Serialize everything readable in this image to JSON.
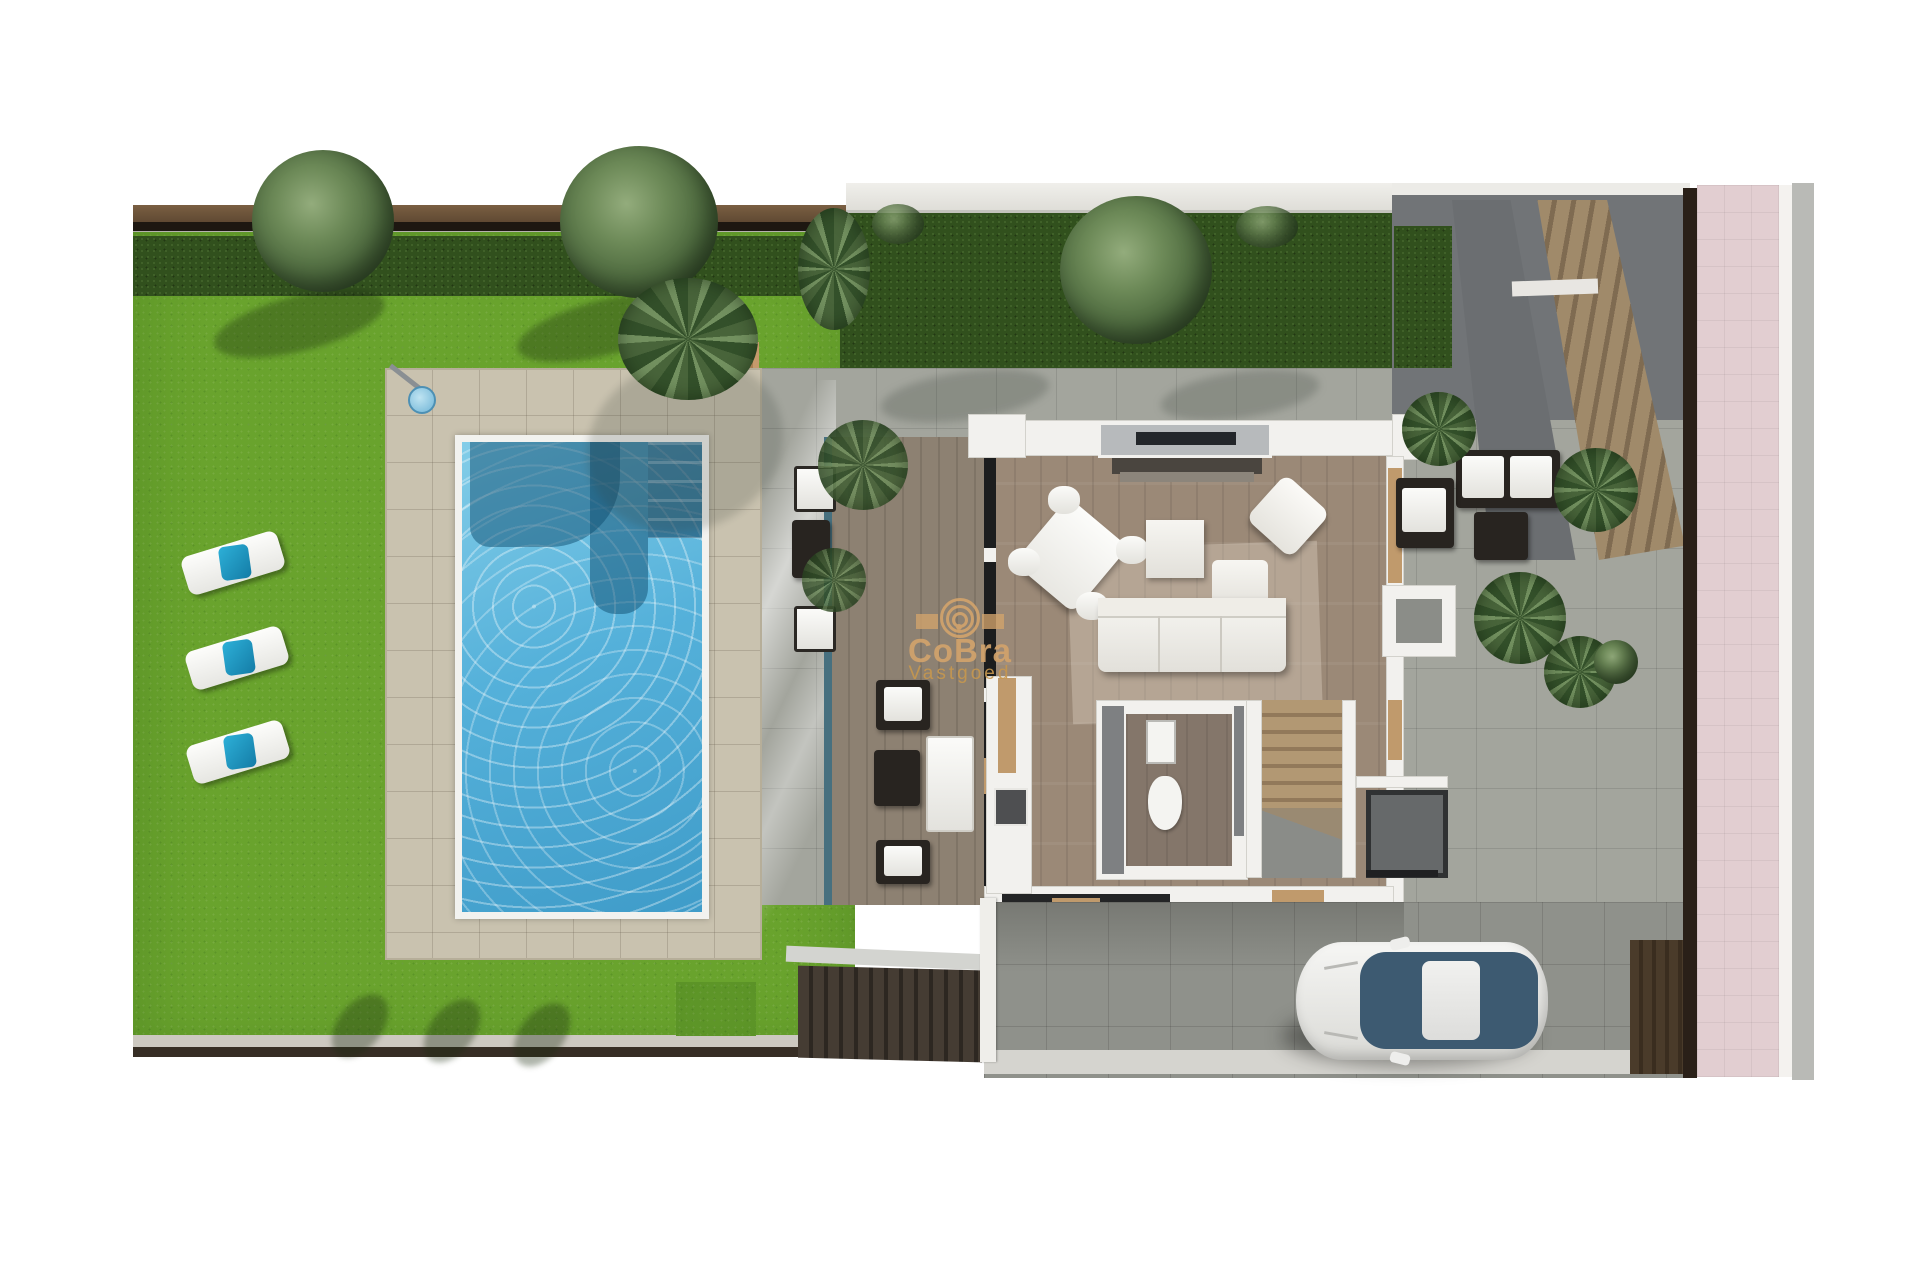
{
  "title": "Villa top-view 3D floor-plan render",
  "watermark": {
    "brand": "CoBra",
    "subtitle": "Vastgoed",
    "logo": "spiral-icon",
    "color": "#d2a36c"
  },
  "scene": {
    "garden": {
      "lawn": "bright green grass",
      "hedge": "dark green perimeter hedge",
      "fence": "brown boundary fence",
      "sun_loungers": 3,
      "lounger_cushion_color": "#1e9fc2",
      "outdoor_shower": 1,
      "boundary_trees": 4
    },
    "pool": {
      "water_color": "#55b1da",
      "coping_color": "#f2f2ef",
      "features": [
        "curved submerged bench",
        "corner entry steps"
      ],
      "deck": "beige stone tile deck"
    },
    "terrace": {
      "floor": "covered wood deck",
      "glazing_color": "#47707f",
      "furniture": [
        "armchair",
        "side table",
        "daybed",
        "armchair",
        "poolside chairs"
      ]
    },
    "house": {
      "rooms": [
        "living-dining room",
        "kitchen",
        "bathroom",
        "staircase",
        "entry hall"
      ],
      "living_room_items": [
        "dining table with 4 chairs",
        "coffee table",
        "rotated armchair",
        "corner sofa with chaise",
        "tv sideboard under window"
      ],
      "kitchen_items": [
        "counter run with cooktop",
        "tall cabinet"
      ],
      "bathroom_items": [
        "washbasin",
        "toilet"
      ],
      "wall_color": "#f2f1ee",
      "accent_wood_color": "#c09a6c"
    },
    "exterior_right": {
      "patio": "grey tile patio",
      "outdoor_lounge": [
        "corner sofa with white cushions",
        "dark coffee table"
      ],
      "palm_plants": 4,
      "round_bush": 1,
      "external_staircase": "diagonal wooden stairs",
      "basement_stairs": "dark ribbed stairwell at street side"
    },
    "driveway": {
      "car": "white sedan seen from above",
      "car_glass_color": "#3d5a71",
      "paving": "grey tiles"
    },
    "street_side": {
      "pink_pavement_color": "#e2ced1",
      "grey_road_strip_color": "#b9bab6",
      "dark_boundary_wall": "#2a2018"
    }
  },
  "palette": {
    "grass": "#69a32d",
    "hedge": "#31501d",
    "pool_water": "#55b1da",
    "pool_deck": "#c9c2af",
    "wood_floor": "#9b8977",
    "terrace_wood": "#8d8172",
    "patio_grey": "#a3a59d",
    "driveway_grey": "#8f918b",
    "wall_white": "#f2f1ee",
    "accent_tan": "#c09a6c",
    "pink": "#e2ced1",
    "watermark": "#d2a36c"
  }
}
